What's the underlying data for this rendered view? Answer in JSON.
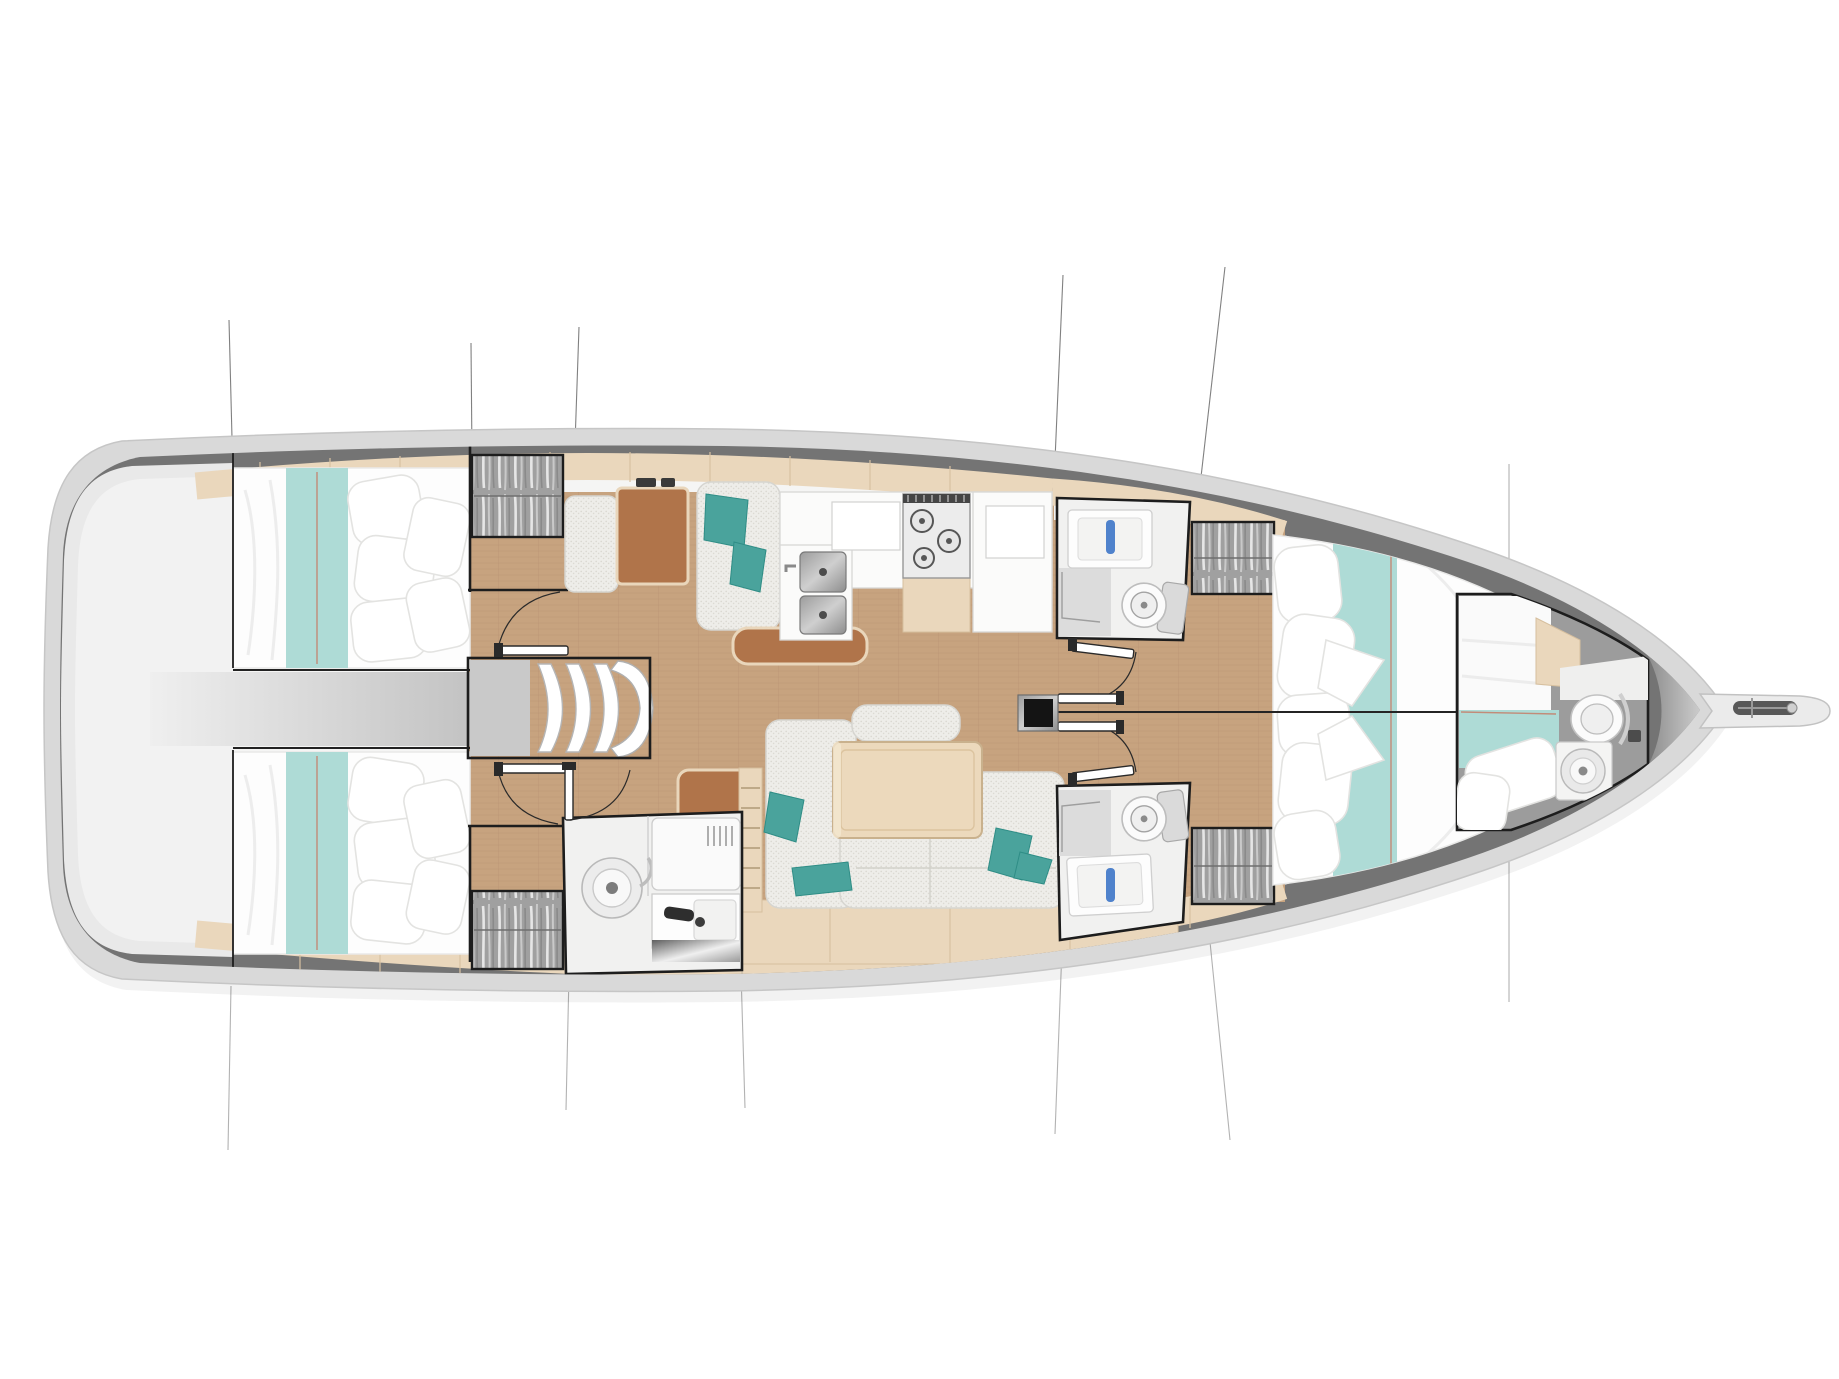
{
  "app": {
    "title": "Sailing yacht interior layout — top-view floor plan"
  },
  "palette": {
    "hull_light": "#d9d9d9",
    "hull_edge": "#c6c6c6",
    "deck_dark": "#747474",
    "floor_white": "#f5f5f4",
    "platform": "#e9e9e9",
    "platform_inner": "#f2f2f2",
    "wood_floor": "#c7a37f",
    "wood_floor_line": "#bd9a76",
    "beige": "#ead7bc",
    "beige_edge": "#d6bf9e",
    "leather": "#b0744a",
    "leather_edge": "#e9d6bb",
    "fabric_edge": "#d6d5d0",
    "teal_light": "#aedbd6",
    "teal": "#4aa39c",
    "teal_dark": "#2f8d86",
    "bed_white": "#fdfdfd",
    "bed_shadow": "#e9e9e8",
    "locker_gray": "#9e9e9e",
    "wall_black": "#1d1d1d",
    "line_gray": "#565656",
    "blue_faucet": "#4f82cc",
    "red_seam": "#c4826e",
    "crew_gray": "#9c9c9c",
    "white_fix": "#f4f4f3",
    "table_wood": "#ecd9bc"
  },
  "rooms": [
    {
      "id": "aft-cabin-port",
      "label": "Aft double cabin (port)"
    },
    {
      "id": "aft-cabin-starboard",
      "label": "Aft double cabin (starboard)"
    },
    {
      "id": "swim-platform",
      "label": "Stern swim platform"
    },
    {
      "id": "engine-compartment",
      "label": "Engine compartment passage"
    },
    {
      "id": "companionway",
      "label": "Companionway steps"
    },
    {
      "id": "nav-station",
      "label": "Chart table / navigation station"
    },
    {
      "id": "galley",
      "label": "Galley with sinks and stove"
    },
    {
      "id": "settee-port",
      "label": "Port settee"
    },
    {
      "id": "salon",
      "label": "Saloon settee and dining table"
    },
    {
      "id": "aft-head",
      "label": "Aft heads with shower and basin"
    },
    {
      "id": "head-port",
      "label": "Forward heads (port)"
    },
    {
      "id": "head-starboard",
      "label": "Forward heads (starboard)"
    },
    {
      "id": "owner-cabin",
      "label": "Forward owner cabin, V-berth"
    },
    {
      "id": "bow-cabin",
      "label": "Bow crew cabin with toilet"
    },
    {
      "id": "bowsprit",
      "label": "Bowsprit and anchor roller"
    },
    {
      "id": "mast",
      "label": "Mast post"
    },
    {
      "id": "wardrobes",
      "label": "Hanging lockers"
    }
  ]
}
